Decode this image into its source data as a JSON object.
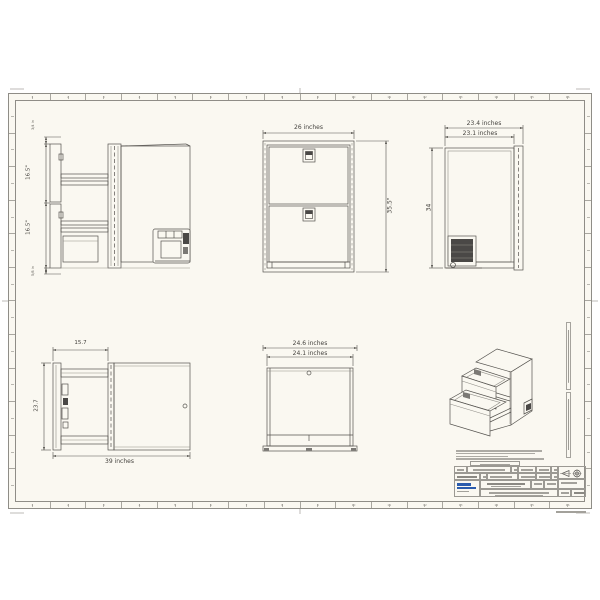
{
  "sheet": {
    "ruler_numbers": [
      "1",
      "2",
      "3",
      "4",
      "5",
      "6",
      "7",
      "8",
      "9",
      "10",
      "11",
      "12",
      "13",
      "14",
      "15",
      "16"
    ]
  },
  "dims": {
    "side_section_top": "3/4 in",
    "side_section_upper": "16.5\"",
    "side_section_lower": "16.5\"",
    "side_section_bottom": "5/8 in",
    "front_width": "26 inches",
    "front_height": "35.5\"",
    "side_depth_overall": "23.4 inches",
    "side_depth_body": "23.1 inches",
    "side_height": "34",
    "top_open_extension": "15.7",
    "top_open_width": "23.7",
    "top_open_length": "39 inches",
    "top_closed_overall": "24.6 inches",
    "top_closed_body": "24.1 inches"
  },
  "colors": {
    "paper": "#faf8f1",
    "line": "#54524e",
    "logo_blue": "#2b5cad"
  }
}
